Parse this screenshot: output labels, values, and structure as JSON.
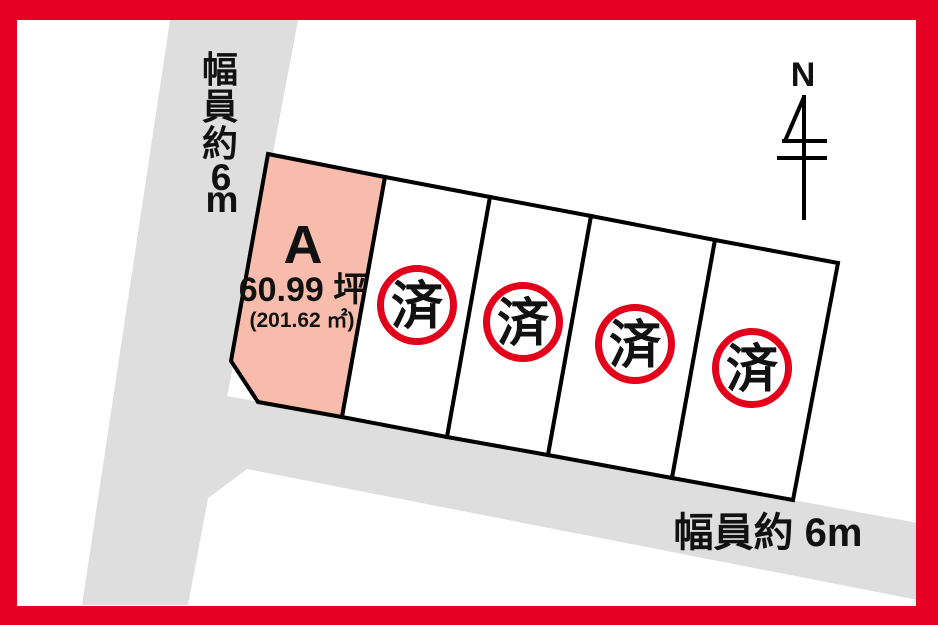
{
  "colors": {
    "frame_red": "#e60023",
    "stamp_red": "#e2001a",
    "road_gray": "#dedede",
    "lot_a_pink": "#f7bcac",
    "lot_white": "#ffffff"
  },
  "compass": {
    "label": "N"
  },
  "roads": {
    "left": {
      "label": "幅員約6m",
      "chars": [
        "幅",
        "員",
        "約",
        "6",
        "m"
      ]
    },
    "bottom": {
      "label": "幅員約 6m"
    }
  },
  "lots": {
    "featured": {
      "id": "A",
      "area_tsubo": "60.99 坪",
      "area_sqm": "(201.62 ㎡)",
      "status": "available"
    },
    "sold": [
      {
        "id": "lot-2",
        "stamp": "済"
      },
      {
        "id": "lot-3",
        "stamp": "済"
      },
      {
        "id": "lot-4",
        "stamp": "済"
      },
      {
        "id": "lot-5",
        "stamp": "済"
      }
    ]
  }
}
